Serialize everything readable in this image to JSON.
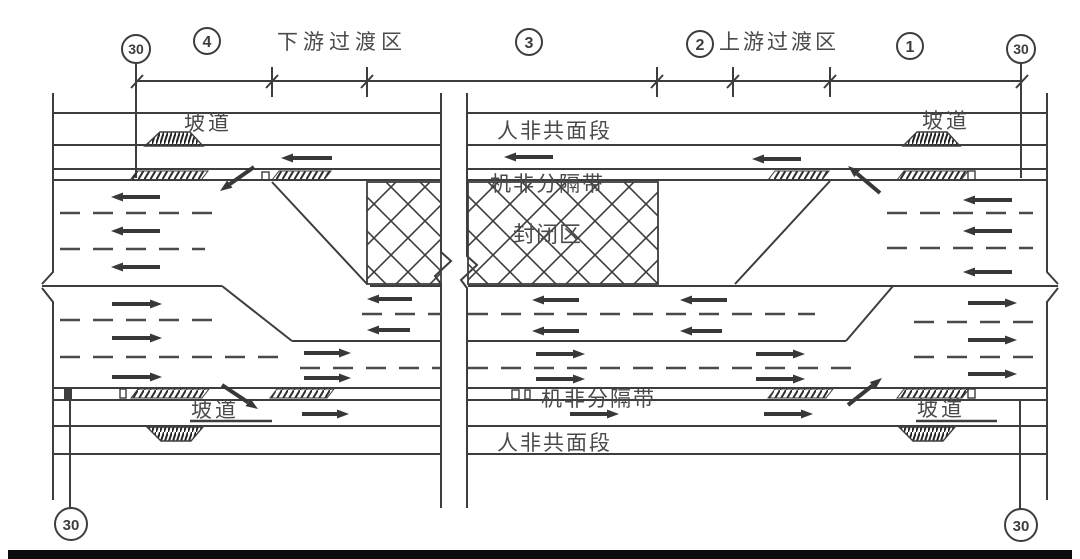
{
  "figure": {
    "kind": "urban-road work-zone traffic organization diagram",
    "colors": {
      "line": "#3d3d3d",
      "text": "#4a4a4a",
      "background": "#ffffff",
      "bottom_bar": "#0c0c0c"
    }
  },
  "zones": {
    "downstream_transition": "下游过渡区",
    "upstream_transition": "上游过渡区",
    "marker_1": "1",
    "marker_2": "2",
    "marker_3": "3",
    "marker_4": "4"
  },
  "signs": {
    "speed_limit": "30"
  },
  "road_labels": {
    "ramp": "坡道",
    "ped_nonmotor_shared_top": "人非共面段",
    "ped_nonmotor_shared_bottom": "人非共面段",
    "motor_nonmotor_divider_top": "机非分隔带",
    "motor_nonmotor_divider_bottom": "机非分隔带",
    "closed_area": "封闭区"
  }
}
